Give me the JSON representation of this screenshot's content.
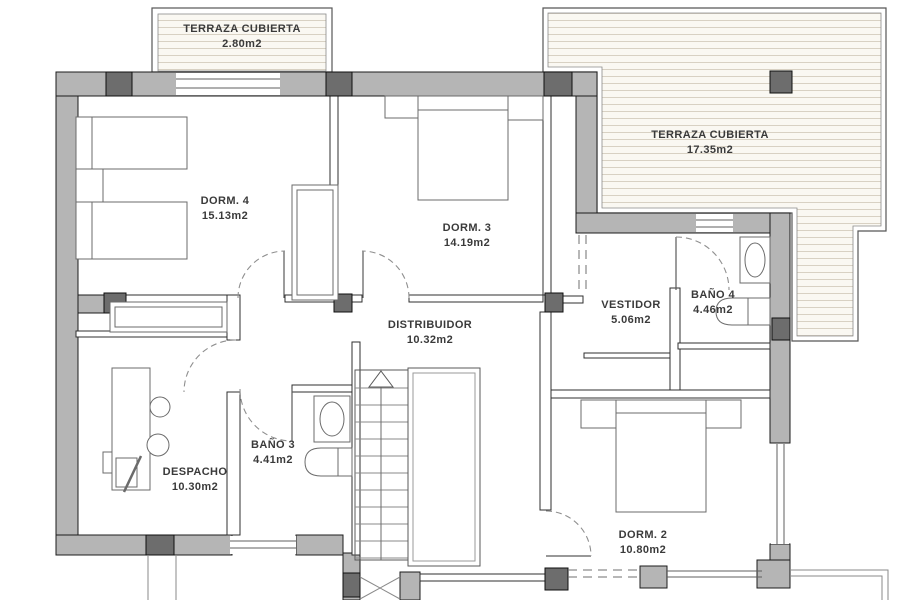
{
  "colors": {
    "wall": "#b5b5b5",
    "pillar": "#6d6d6d",
    "dashed": "#8f8f8f",
    "deckfill": "#faf8f2",
    "deckline": "#d8d1c3",
    "label": "#3a3a3a"
  },
  "rooms": [
    {
      "id": "terraza-cubierta-small",
      "name": "TERRAZA CUBIERTA",
      "area": "2.80m2"
    },
    {
      "id": "terraza-cubierta-large",
      "name": "TERRAZA CUBIERTA",
      "area": "17.35m2"
    },
    {
      "id": "dorm-4",
      "name": "DORM. 4",
      "area": "15.13m2"
    },
    {
      "id": "dorm-3",
      "name": "DORM. 3",
      "area": "14.19m2"
    },
    {
      "id": "vestidor",
      "name": "VESTIDOR",
      "area": "5.06m2"
    },
    {
      "id": "bano-4",
      "name": "BAÑO 4",
      "area": "4.46m2"
    },
    {
      "id": "distribuidor",
      "name": "DISTRIBUIDOR",
      "area": "10.32m2"
    },
    {
      "id": "bano-3",
      "name": "BAÑO 3",
      "area": "4.41m2"
    },
    {
      "id": "despacho",
      "name": "DESPACHO",
      "area": "10.30m2"
    },
    {
      "id": "dorm-2",
      "name": "DORM. 2",
      "area": "10.80m2"
    }
  ]
}
